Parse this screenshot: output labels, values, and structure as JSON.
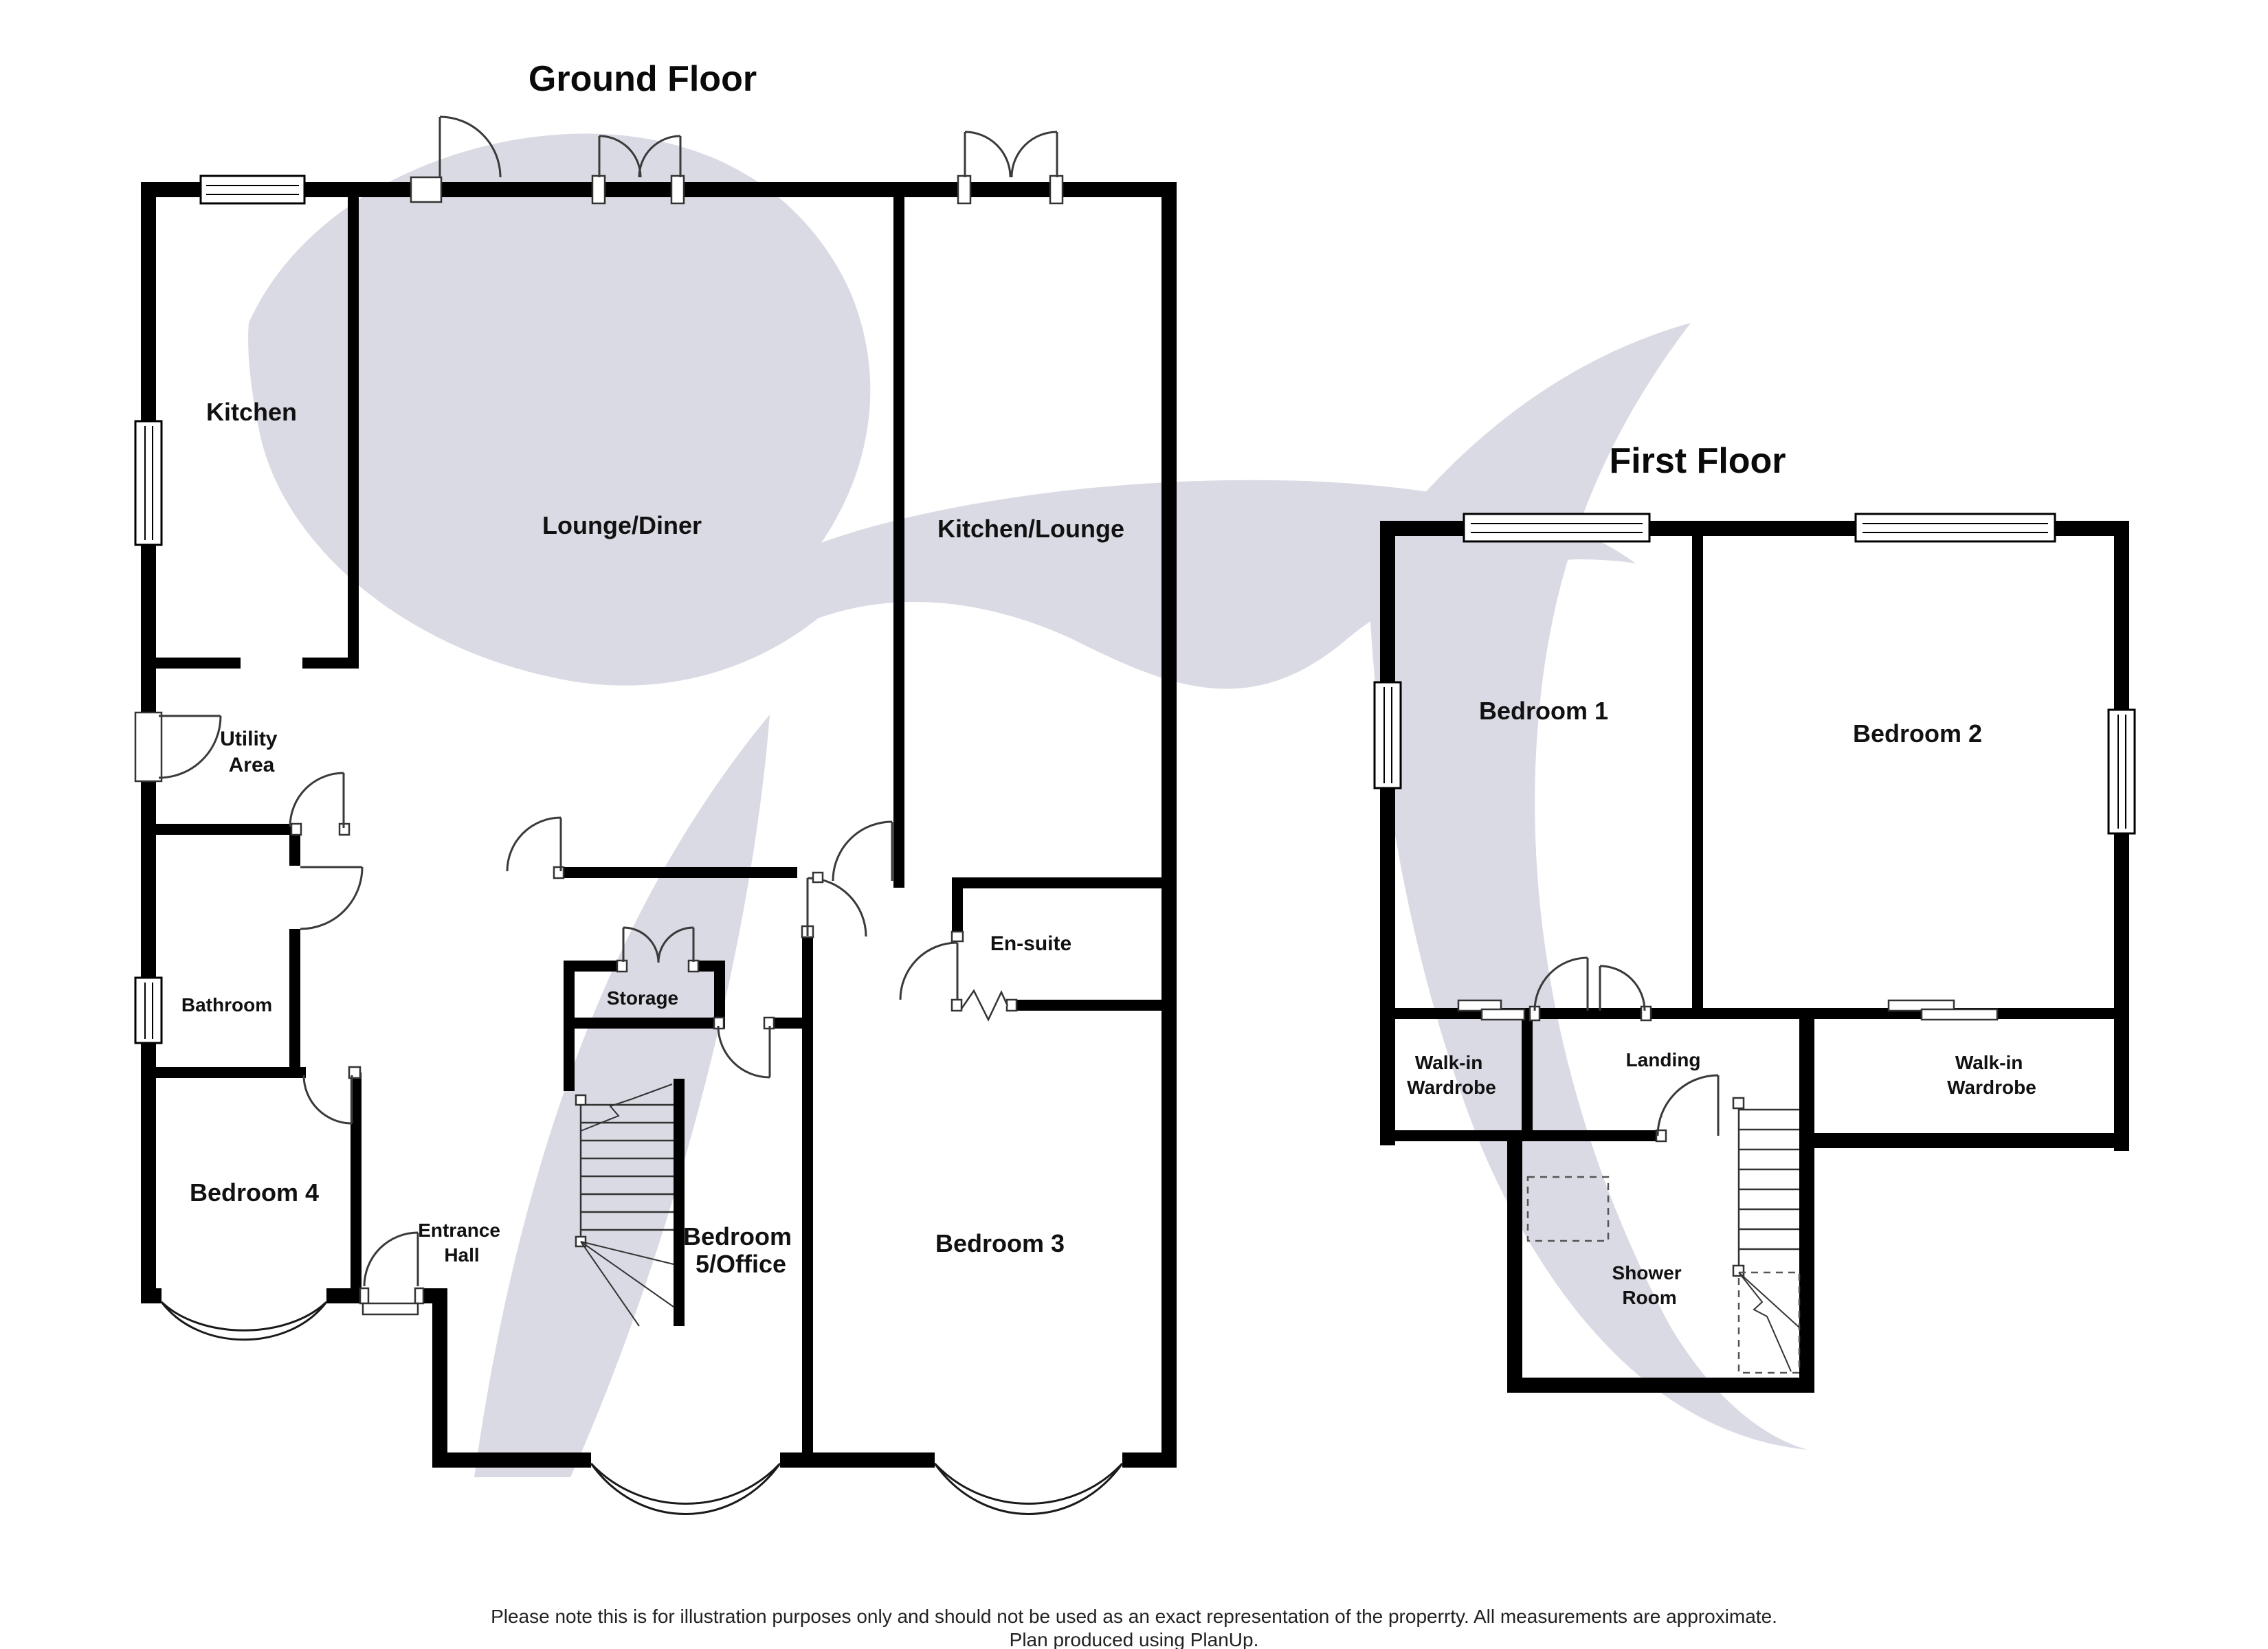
{
  "ground_floor": {
    "title": "Ground Floor",
    "rooms": {
      "kitchen": "Kitchen",
      "lounge_diner": "Lounge/Diner",
      "kitchen_lounge": "Kitchen/Lounge",
      "utility_line1": "Utility",
      "utility_line2": "Area",
      "bathroom": "Bathroom",
      "bedroom4": "Bedroom 4",
      "entrance_line1": "Entrance",
      "entrance_line2": "Hall",
      "storage": "Storage",
      "bedroom5_line1": "Bedroom",
      "bedroom5_line2": "5/Office",
      "bedroom3": "Bedroom 3",
      "ensuite": "En-suite"
    },
    "features": [
      "kitchen-window",
      "rear-door",
      "french-doors-lounge",
      "french-doors-kitchen-lounge",
      "side-door-utility",
      "bathroom-window",
      "bay-window-bedroom4",
      "front-door",
      "staircase",
      "bay-window-bedroom5",
      "bay-window-bedroom3",
      "open-plan-divider-ensuite"
    ]
  },
  "first_floor": {
    "title": "First Floor",
    "rooms": {
      "bedroom1": "Bedroom 1",
      "bedroom2": "Bedroom 2",
      "wardrobe_left_line1": "Walk-in",
      "wardrobe_left_line2": "Wardrobe",
      "landing": "Landing",
      "wardrobe_right_line1": "Walk-in",
      "wardrobe_right_line2": "Wardrobe",
      "shower_line1": "Shower",
      "shower_line2": "Room"
    },
    "features": [
      "bedroom1-window",
      "bedroom2-window",
      "side-window-bedroom1",
      "side-window-bedroom2",
      "staircase",
      "shower-tray",
      "sliding-wardrobe-doors"
    ]
  },
  "footer": {
    "disclaimer": "Please note this is for illustration purposes only and should not be used as an exact representation of the properrty. All measurements are approximate.",
    "credit": "Plan produced using PlanUp."
  },
  "colors": {
    "wall": "#000000",
    "watermark": "#d9dae3",
    "door_arc": "#3a3a3a"
  }
}
